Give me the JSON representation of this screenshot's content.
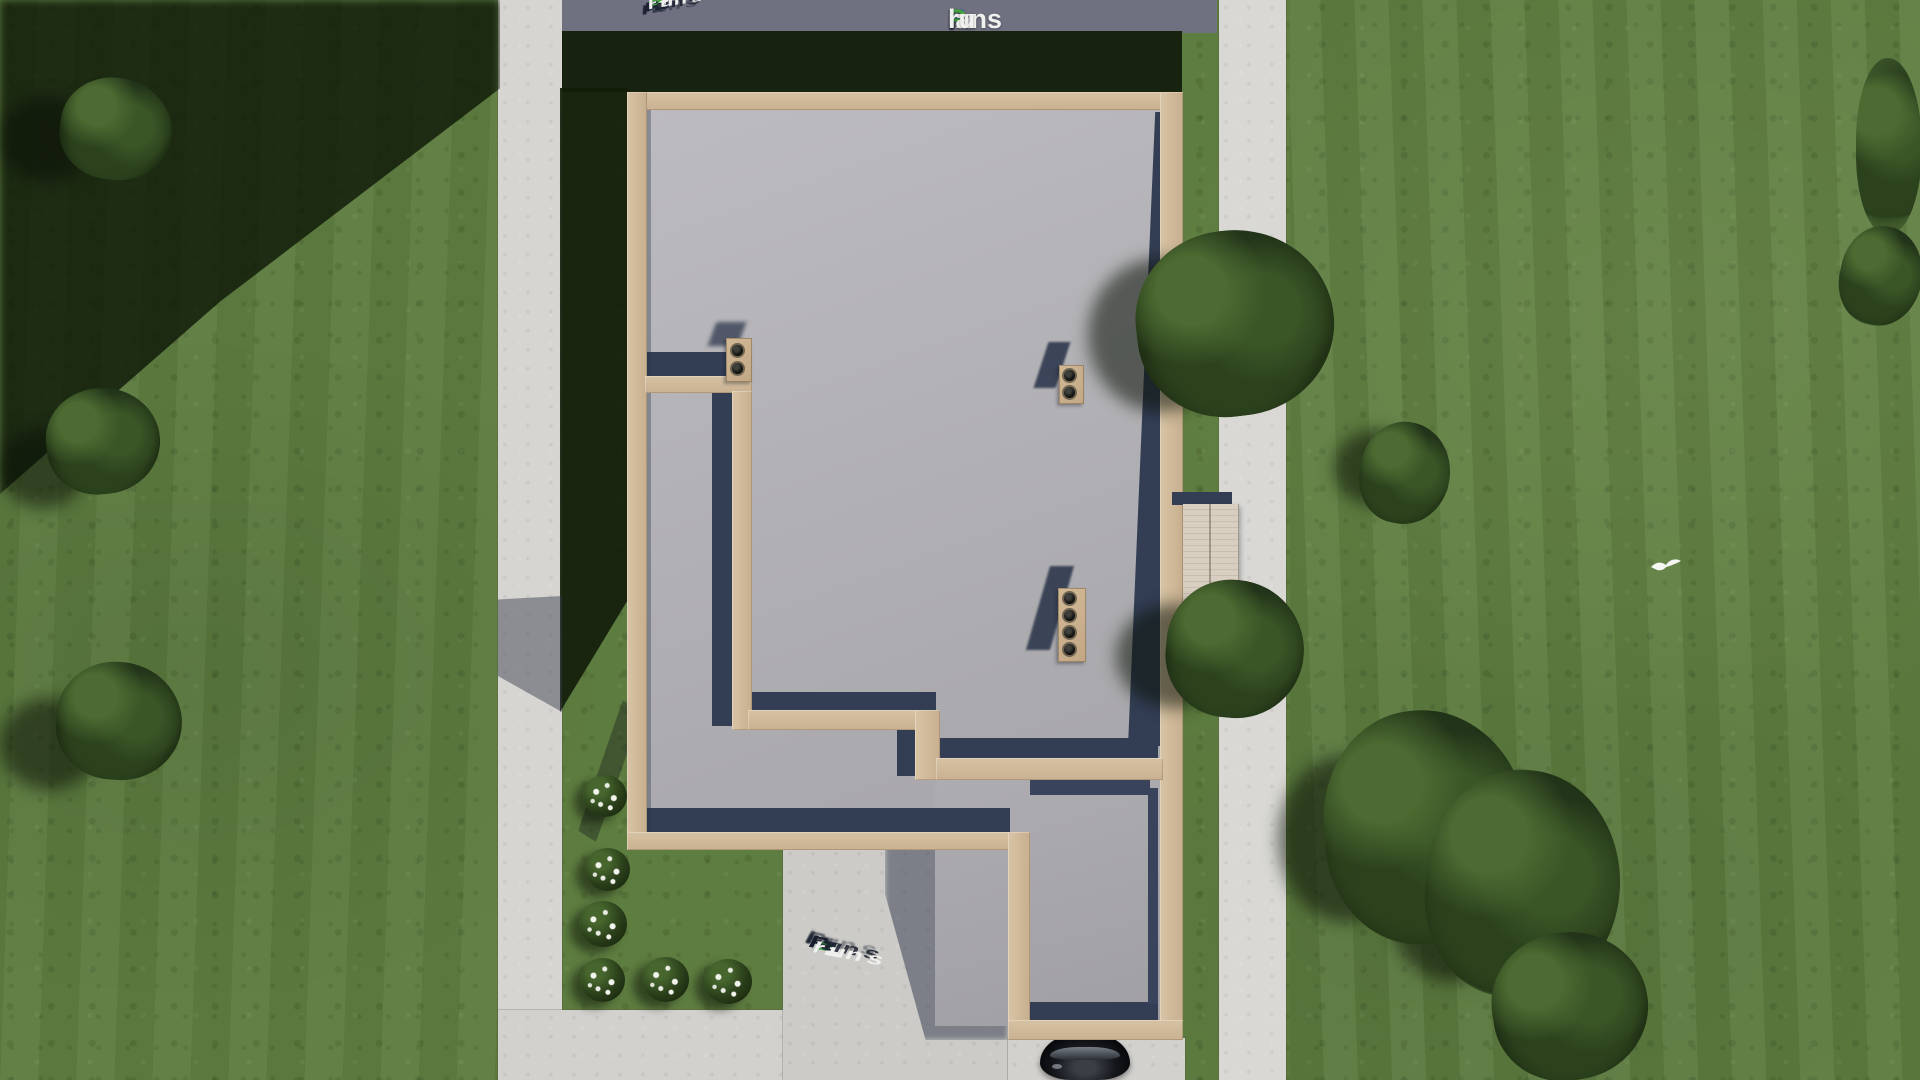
{
  "meta": {
    "canvas_width": 1920,
    "canvas_height": 1080,
    "scene_type": "top-down 3D render of a single-storey house wall plan on a landscaped lot"
  },
  "watermark": {
    "brand_full": "FixPlans.ru",
    "parts": [
      {
        "t": "F",
        "c": "#2f5cd6"
      },
      {
        "t": "ix",
        "c": "#f0f0ee"
      },
      {
        "t": "P",
        "c": "#3ea43a"
      },
      {
        "t": "lans",
        "c": "#f0f0ee"
      },
      {
        "t": ".",
        "c": "#2f5cd6"
      },
      {
        "t": "ru",
        "c": "#f0f0ee"
      }
    ],
    "placements": [
      {
        "id": "flat-top-right",
        "style": "flat logo text"
      },
      {
        "id": "extruded-top-left",
        "style": "3D extruded letters lying on ground, rising to the right"
      },
      {
        "id": "extruded-bottom-center",
        "style": "3D extruded letters lying on driveway, descending to the right"
      }
    ]
  },
  "scene": {
    "building": {
      "label": "roofless house walls seen from directly above",
      "wall_color": "#cfb898",
      "floor_color": "#b2b1b5",
      "interior_shadow_color": "#333e55",
      "sections": [
        "main rectangle",
        "garage extension bottom-right"
      ],
      "chimneys": [
        {
          "id": "chimney-1",
          "vents": 2,
          "location": "end of upper-left interior wall"
        },
        {
          "id": "chimney-2",
          "vents": 2,
          "location": "free-standing in main room"
        },
        {
          "id": "chimney-3",
          "vents": 4,
          "location": "free-standing lower in main room"
        }
      ],
      "deck": {
        "label": "wood plank porch on east side",
        "color": "#d3c9bc"
      }
    },
    "site": {
      "grass_color": "#5e7d40",
      "shadow_grass_color": "#17230e",
      "concrete_color": "#d6d5d1",
      "shadowed_concrete_color": "#6f7180",
      "sidewalk": "vertical strip left of house",
      "path_right": "vertical strip right of house",
      "driveway": "bottom center leading to garage",
      "tree_count": 11,
      "flower_bush_count": 6,
      "car": {
        "label": "black car parked at garage door, partly under wall",
        "color": "#0d0f13"
      },
      "bird": {
        "label": "small white bird flying over right lawn",
        "color": "#f5f7f4"
      }
    }
  }
}
